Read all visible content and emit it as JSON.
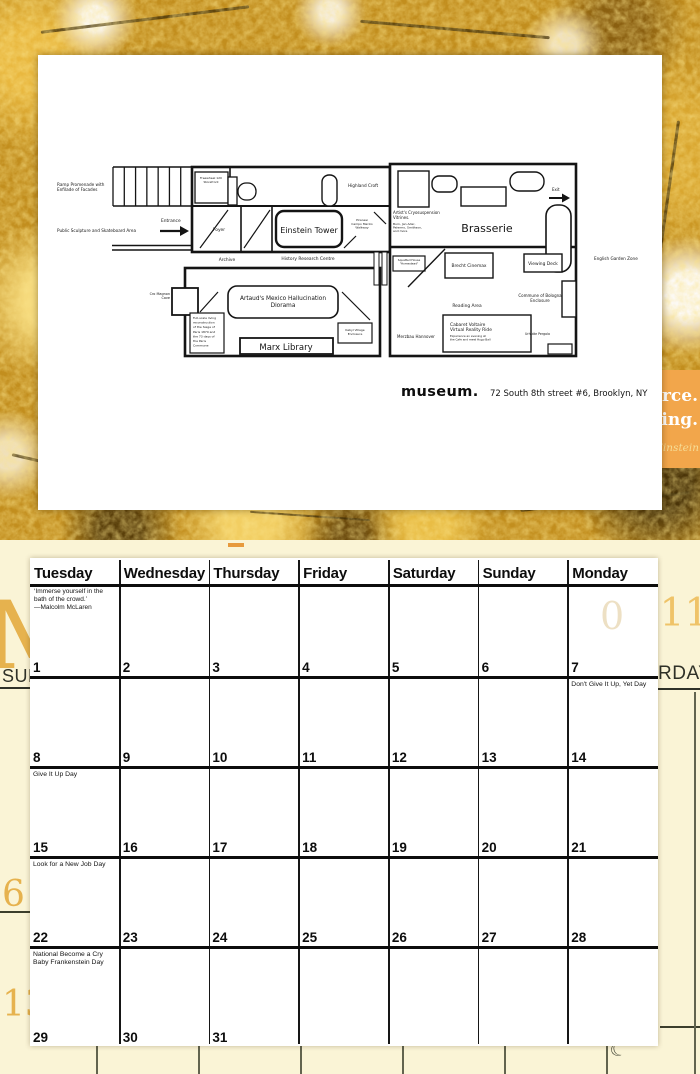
{
  "page": {
    "logo": "museum.",
    "address": "72 South 8th street #6, Brooklyn, NY"
  },
  "peek": {
    "line1": "orce.",
    "line2": "ding.",
    "attribution": "Einstein",
    "block_color": "#F2A64B"
  },
  "underlay": {
    "month_letter": "M",
    "year": "2011",
    "ghost_digit": "0",
    "left_day_fragment": "SUN",
    "right_day_fragment": "RDAY",
    "margin_date_1": "6",
    "margin_date_2": "13",
    "moon_icon": "☾",
    "bg_color": "#FAF4D6",
    "accent_gold": "#E6B24E"
  },
  "floorplan": {
    "viewBox": "46 147 620 226",
    "ink": "#141414",
    "shapes": [
      {
        "t": "l",
        "x1": 113,
        "y1": 167,
        "x2": 192,
        "y2": 167,
        "sw": 1.6,
        "n": "ramp-edge"
      },
      {
        "t": "l",
        "x1": 113,
        "y1": 206,
        "x2": 192,
        "y2": 206,
        "sw": 1.6,
        "n": "ramp-edge"
      },
      {
        "t": "stairs",
        "x": 113,
        "y": 167,
        "w": 79,
        "h": 39,
        "count": 8,
        "sw": 1.3,
        "n": "ramp-treads"
      },
      {
        "t": "l",
        "x1": 112,
        "y1": 245.5,
        "x2": 192,
        "y2": 245.5,
        "sw": 1.4,
        "n": "entry-corridor-wall"
      },
      {
        "t": "l",
        "x1": 112,
        "y1": 250,
        "x2": 192,
        "y2": 250,
        "sw": 1.4,
        "n": "entry-corridor-wall"
      },
      {
        "t": "r",
        "x": 192,
        "y": 167,
        "w": 198,
        "h": 85,
        "sw": 2.6,
        "n": "upper-wing-outline"
      },
      {
        "t": "r",
        "x": 390,
        "y": 164,
        "w": 186,
        "h": 192,
        "sw": 2.6,
        "n": "east-wing-outline"
      },
      {
        "t": "r",
        "x": 185,
        "y": 268,
        "w": 195,
        "h": 88,
        "sw": 2.6,
        "n": "lower-wing-outline"
      },
      {
        "t": "r",
        "x": 172,
        "y": 288,
        "w": 26,
        "h": 27,
        "sw": 1.8,
        "n": "cro-magnon-cave-room"
      },
      {
        "t": "l",
        "x1": 192,
        "y1": 206,
        "x2": 390,
        "y2": 206,
        "sw": 2,
        "n": "interior-wall"
      },
      {
        "t": "l",
        "x1": 230,
        "y1": 167,
        "x2": 230,
        "y2": 206,
        "sw": 1.6,
        "n": "interior-wall"
      },
      {
        "t": "l",
        "x1": 241,
        "y1": 206,
        "x2": 241,
        "y2": 252,
        "sw": 1.6,
        "n": "interior-wall"
      },
      {
        "t": "l",
        "x1": 272,
        "y1": 206,
        "x2": 272,
        "y2": 252,
        "sw": 1.6,
        "n": "interior-wall"
      },
      {
        "t": "r",
        "x": 195,
        "y": 172,
        "w": 33,
        "h": 31,
        "sw": 1.3,
        "n": "storefront-room"
      },
      {
        "t": "r",
        "x": 228,
        "y": 177,
        "w": 9,
        "h": 28,
        "sw": 1.3,
        "n": "fixture"
      },
      {
        "t": "r",
        "x": 238,
        "y": 183,
        "w": 18,
        "h": 17,
        "rx": 8,
        "sw": 1.3,
        "n": "fixture"
      },
      {
        "t": "r",
        "x": 322,
        "y": 175,
        "w": 15,
        "h": 31,
        "rx": 7,
        "sw": 1.4,
        "n": "fixture"
      },
      {
        "t": "r",
        "x": 276,
        "y": 211,
        "w": 66,
        "h": 36,
        "rx": 8,
        "sw": 2.4,
        "n": "einstein-tower-room"
      },
      {
        "t": "l",
        "x1": 200,
        "y1": 248,
        "x2": 228,
        "y2": 210,
        "sw": 1.2,
        "n": "door-swing"
      },
      {
        "t": "l",
        "x1": 244,
        "y1": 248,
        "x2": 270,
        "y2": 210,
        "sw": 1.2,
        "n": "door-swing"
      },
      {
        "t": "l",
        "x1": 344,
        "y1": 248,
        "x2": 356,
        "y2": 236,
        "sw": 1.2,
        "n": "door-swing"
      },
      {
        "t": "l",
        "x1": 374,
        "y1": 212,
        "x2": 386,
        "y2": 224,
        "sw": 1.2,
        "n": "door-swing"
      },
      {
        "t": "l",
        "x1": 390,
        "y1": 247,
        "x2": 576,
        "y2": 247,
        "sw": 2.4,
        "n": "interior-wall"
      },
      {
        "t": "r",
        "x": 398,
        "y": 171,
        "w": 31,
        "h": 36,
        "sw": 1.4,
        "n": "furniture"
      },
      {
        "t": "r",
        "x": 432,
        "y": 176,
        "w": 25,
        "h": 16,
        "rx": 7,
        "sw": 1.4,
        "n": "furniture"
      },
      {
        "t": "r",
        "x": 461,
        "y": 187,
        "w": 45,
        "h": 19,
        "sw": 1.4,
        "n": "furniture"
      },
      {
        "t": "r",
        "x": 510,
        "y": 172,
        "w": 34,
        "h": 19,
        "rx": 9,
        "sw": 1.4,
        "n": "furniture"
      },
      {
        "t": "r",
        "x": 546,
        "y": 205,
        "w": 25,
        "h": 67,
        "rx": 11,
        "sw": 1.6,
        "n": "furniture"
      },
      {
        "t": "r",
        "x": 374,
        "y": 252,
        "w": 5,
        "h": 33,
        "sw": 1,
        "n": "fixture"
      },
      {
        "t": "r",
        "x": 382,
        "y": 252,
        "w": 5,
        "h": 33,
        "sw": 1,
        "n": "fixture"
      },
      {
        "t": "r",
        "x": 393,
        "y": 256,
        "w": 32,
        "h": 15,
        "sw": 1.2,
        "n": "squatted-house-room"
      },
      {
        "t": "l",
        "x1": 408,
        "y1": 287,
        "x2": 445,
        "y2": 249,
        "sw": 1.4,
        "n": "ramp-wall"
      },
      {
        "t": "r",
        "x": 445,
        "y": 253,
        "w": 48,
        "h": 25,
        "sw": 1.4,
        "n": "brecht-cinemax-room"
      },
      {
        "t": "r",
        "x": 524,
        "y": 254,
        "w": 38,
        "h": 18,
        "sw": 1.4,
        "n": "viewing-deck-room"
      },
      {
        "t": "r",
        "x": 562,
        "y": 281,
        "w": 14,
        "h": 36,
        "sw": 1.4,
        "n": "enclosure-bump"
      },
      {
        "t": "r",
        "x": 548,
        "y": 344,
        "w": 24,
        "h": 10,
        "sw": 1.2,
        "n": "fixture"
      },
      {
        "t": "r",
        "x": 443,
        "y": 315,
        "w": 88,
        "h": 37,
        "sw": 1.4,
        "n": "cabaret-voltaire-room"
      },
      {
        "t": "r",
        "x": 228,
        "y": 286,
        "w": 110,
        "h": 32,
        "rx": 9,
        "sw": 1.6,
        "n": "artaud-diorama-room"
      },
      {
        "t": "r",
        "x": 190,
        "y": 313,
        "w": 34,
        "h": 40,
        "sw": 1.2,
        "n": "paris-commune-room"
      },
      {
        "t": "r",
        "x": 240,
        "y": 338,
        "w": 93,
        "h": 16,
        "sw": 1.8,
        "n": "marx-library-room"
      },
      {
        "t": "r",
        "x": 338,
        "y": 323,
        "w": 34,
        "h": 20,
        "sw": 1.2,
        "n": "kabyl-village-room"
      },
      {
        "t": "l",
        "x1": 342,
        "y1": 292,
        "x2": 370,
        "y2": 320,
        "sw": 1.2,
        "n": "ramp-wall"
      },
      {
        "t": "l",
        "x1": 200,
        "y1": 312,
        "x2": 218,
        "y2": 292,
        "sw": 1.2,
        "n": "door-swing"
      },
      {
        "t": "l",
        "x1": 160,
        "y1": 231,
        "x2": 180,
        "y2": 231,
        "sw": 2.2,
        "n": "entrance-arrow"
      },
      {
        "t": "p",
        "pts": "180,226 189,231 180,236",
        "n": "entrance-arrow-head"
      },
      {
        "t": "l",
        "x1": 549,
        "y1": 198,
        "x2": 562,
        "y2": 198,
        "sw": 2,
        "n": "exit-arrow"
      },
      {
        "t": "p",
        "pts": "562,193.5 570,198 562,202.5",
        "n": "exit-arrow-head"
      }
    ],
    "labels": [
      {
        "name": "label-ramp-promenade",
        "lines": [
          "Ramp Promenade with",
          "Enfilade of Facades"
        ],
        "x": 57,
        "y": 186,
        "s": 4.2,
        "a": "start",
        "lh": 5.2
      },
      {
        "name": "label-public-sculpture",
        "lines": [
          "Public Sculpture and Skateboard Area"
        ],
        "x": 57,
        "y": 232,
        "s": 4.2,
        "a": "start",
        "lh": 5
      },
      {
        "name": "label-entrance",
        "lines": [
          "Entrance"
        ],
        "x": 161,
        "y": 222,
        "s": 4.4,
        "a": "start",
        "lh": 5
      },
      {
        "name": "label-storefront",
        "lines": [
          "Freewheel 120",
          "Storefront"
        ],
        "x": 211,
        "y": 179,
        "s": 3,
        "a": "middle",
        "lh": 3.8
      },
      {
        "name": "label-highland-croft",
        "lines": [
          "Highland Croft"
        ],
        "x": 348,
        "y": 187,
        "s": 4.2,
        "a": "start",
        "lh": 5
      },
      {
        "name": "label-foyer",
        "lines": [
          "Foyer"
        ],
        "x": 219,
        "y": 231,
        "s": 4.4,
        "a": "middle",
        "lh": 5
      },
      {
        "name": "label-einstein-tower",
        "lines": [
          "Einstein Tower"
        ],
        "x": 309,
        "y": 233,
        "s": 8,
        "a": "middle",
        "lh": 9
      },
      {
        "name": "label-piranesi-walkway",
        "lines": [
          "Piranesi",
          "Campo Marzio",
          "Walkway"
        ],
        "x": 362,
        "y": 221,
        "s": 3,
        "a": "middle",
        "lh": 3.8
      },
      {
        "name": "label-exit",
        "lines": [
          "Exit"
        ],
        "x": 552,
        "y": 191,
        "s": 4,
        "a": "start",
        "lh": 5
      },
      {
        "name": "label-cryosuspension",
        "lines": [
          "Artist's Cryosuspension",
          "Vitrines."
        ],
        "x": 393,
        "y": 214,
        "s": 4,
        "a": "start",
        "lh": 4.8
      },
      {
        "name": "label-cryosuspension-artists",
        "lines": [
          "Burn, Jan Ader,",
          "Palermo, Smithson,",
          "and more"
        ],
        "x": 393,
        "y": 225,
        "s": 3,
        "a": "start",
        "lh": 3.6
      },
      {
        "name": "label-brasserie",
        "lines": [
          "Brasserie"
        ],
        "x": 487,
        "y": 232,
        "s": 11,
        "a": "middle",
        "lh": 12
      },
      {
        "name": "label-archive",
        "lines": [
          "Archive"
        ],
        "x": 227,
        "y": 261,
        "s": 4.4,
        "a": "middle",
        "lh": 5
      },
      {
        "name": "label-history-research",
        "lines": [
          "History Research Centre"
        ],
        "x": 308,
        "y": 260,
        "s": 4.4,
        "a": "middle",
        "lh": 5
      },
      {
        "name": "label-squatted-house",
        "lines": [
          "Squatted House",
          "\"Homestead\""
        ],
        "x": 409,
        "y": 261,
        "s": 2.8,
        "a": "middle",
        "lh": 3.4
      },
      {
        "name": "label-brecht-cinemax",
        "lines": [
          "Brecht Cinemax"
        ],
        "x": 469,
        "y": 267,
        "s": 4.4,
        "a": "middle",
        "lh": 5
      },
      {
        "name": "label-viewing-deck",
        "lines": [
          "Viewing Deck"
        ],
        "x": 543,
        "y": 265,
        "s": 4.4,
        "a": "middle",
        "lh": 5
      },
      {
        "name": "label-english-garden",
        "lines": [
          "English Garden Zone"
        ],
        "x": 594,
        "y": 260,
        "s": 4.2,
        "a": "start",
        "lh": 5
      },
      {
        "name": "label-cro-magnon",
        "lines": [
          "Cro Magnon",
          "Cave"
        ],
        "x": 170,
        "y": 295,
        "s": 3.4,
        "a": "end",
        "lh": 4
      },
      {
        "name": "label-commune-bologna",
        "lines": [
          "Commune of Bologna",
          "Enclosure"
        ],
        "x": 540,
        "y": 297,
        "s": 4,
        "a": "middle",
        "lh": 4.8
      },
      {
        "name": "label-reading-area",
        "lines": [
          "Reading Area"
        ],
        "x": 467,
        "y": 307,
        "s": 4.4,
        "a": "middle",
        "lh": 5
      },
      {
        "name": "label-merzbau",
        "lines": [
          "Merzbau Hannover"
        ],
        "x": 416,
        "y": 338,
        "s": 4,
        "a": "middle",
        "lh": 5
      },
      {
        "name": "label-cabaret-voltaire",
        "lines": [
          "Cabaret Voltaire",
          "Virtual Reality Ride"
        ],
        "x": 450,
        "y": 326,
        "s": 4.4,
        "a": "start",
        "lh": 5
      },
      {
        "name": "label-cabaret-desc",
        "lines": [
          "Experience an evening at",
          "the Cafe and meet Hugo Ball"
        ],
        "x": 450,
        "y": 337,
        "s": 2.8,
        "a": "start",
        "lh": 3.4
      },
      {
        "name": "label-urhutte",
        "lines": [
          "Urhutte Pergola"
        ],
        "x": 525,
        "y": 335,
        "s": 3.2,
        "a": "start",
        "lh": 4
      },
      {
        "name": "label-artaud-diorama",
        "lines": [
          "Artaud's Mexico Hallucination",
          "Diorama"
        ],
        "x": 283,
        "y": 300,
        "s": 5.8,
        "a": "middle",
        "lh": 7
      },
      {
        "name": "label-marx-library",
        "lines": [
          "Marx Library"
        ],
        "x": 286,
        "y": 350,
        "s": 8.5,
        "a": "middle",
        "lh": 9
      },
      {
        "name": "label-paris-commune",
        "lines": [
          "Full-scale living",
          "reconstruction",
          "of the Siege of",
          "Paris 1870 and",
          "the 73 days of",
          "the Paris",
          "Commune"
        ],
        "x": 193,
        "y": 319,
        "s": 3,
        "a": "start",
        "lh": 4.6
      },
      {
        "name": "label-kabyl-village",
        "lines": [
          "Kabyl Village",
          "Enclosure"
        ],
        "x": 355,
        "y": 331,
        "s": 3,
        "a": "middle",
        "lh": 3.8
      }
    ]
  },
  "calendar": {
    "day_headers": [
      "Tuesday",
      "Wednesday",
      "Thursday",
      "Friday",
      "Saturday",
      "Sunday",
      "Monday"
    ],
    "quote": {
      "lines": [
        "‘Immerse yourself in the",
        "bath of the crowd.’",
        "—Malcolm McLaren"
      ]
    },
    "weeks": [
      {
        "cells": [
          {
            "date": "1"
          },
          {
            "date": "2"
          },
          {
            "date": "3"
          },
          {
            "date": "4"
          },
          {
            "date": "5"
          },
          {
            "date": "6"
          },
          {
            "date": "7",
            "note": "Don't Give It Up, Yet Day"
          }
        ]
      },
      {
        "cells": [
          {
            "date": "8",
            "note": "Give It Up Day"
          },
          {
            "date": "9"
          },
          {
            "date": "10"
          },
          {
            "date": "11"
          },
          {
            "date": "12"
          },
          {
            "date": "13"
          },
          {
            "date": "14"
          }
        ]
      },
      {
        "cells": [
          {
            "date": "15",
            "note": "Look for a New Job Day"
          },
          {
            "date": "16"
          },
          {
            "date": "17"
          },
          {
            "date": "18"
          },
          {
            "date": "19"
          },
          {
            "date": "20"
          },
          {
            "date": "21"
          }
        ]
      },
      {
        "cells": [
          {
            "date": "22",
            "note": "National Become a Cry Baby Frankenstein Day"
          },
          {
            "date": "23"
          },
          {
            "date": "24"
          },
          {
            "date": "25"
          },
          {
            "date": "26"
          },
          {
            "date": "27"
          },
          {
            "date": "28"
          }
        ]
      },
      {
        "cells": [
          {
            "date": "29"
          },
          {
            "date": "30"
          },
          {
            "date": "31"
          },
          {},
          {},
          {},
          {}
        ]
      }
    ]
  }
}
